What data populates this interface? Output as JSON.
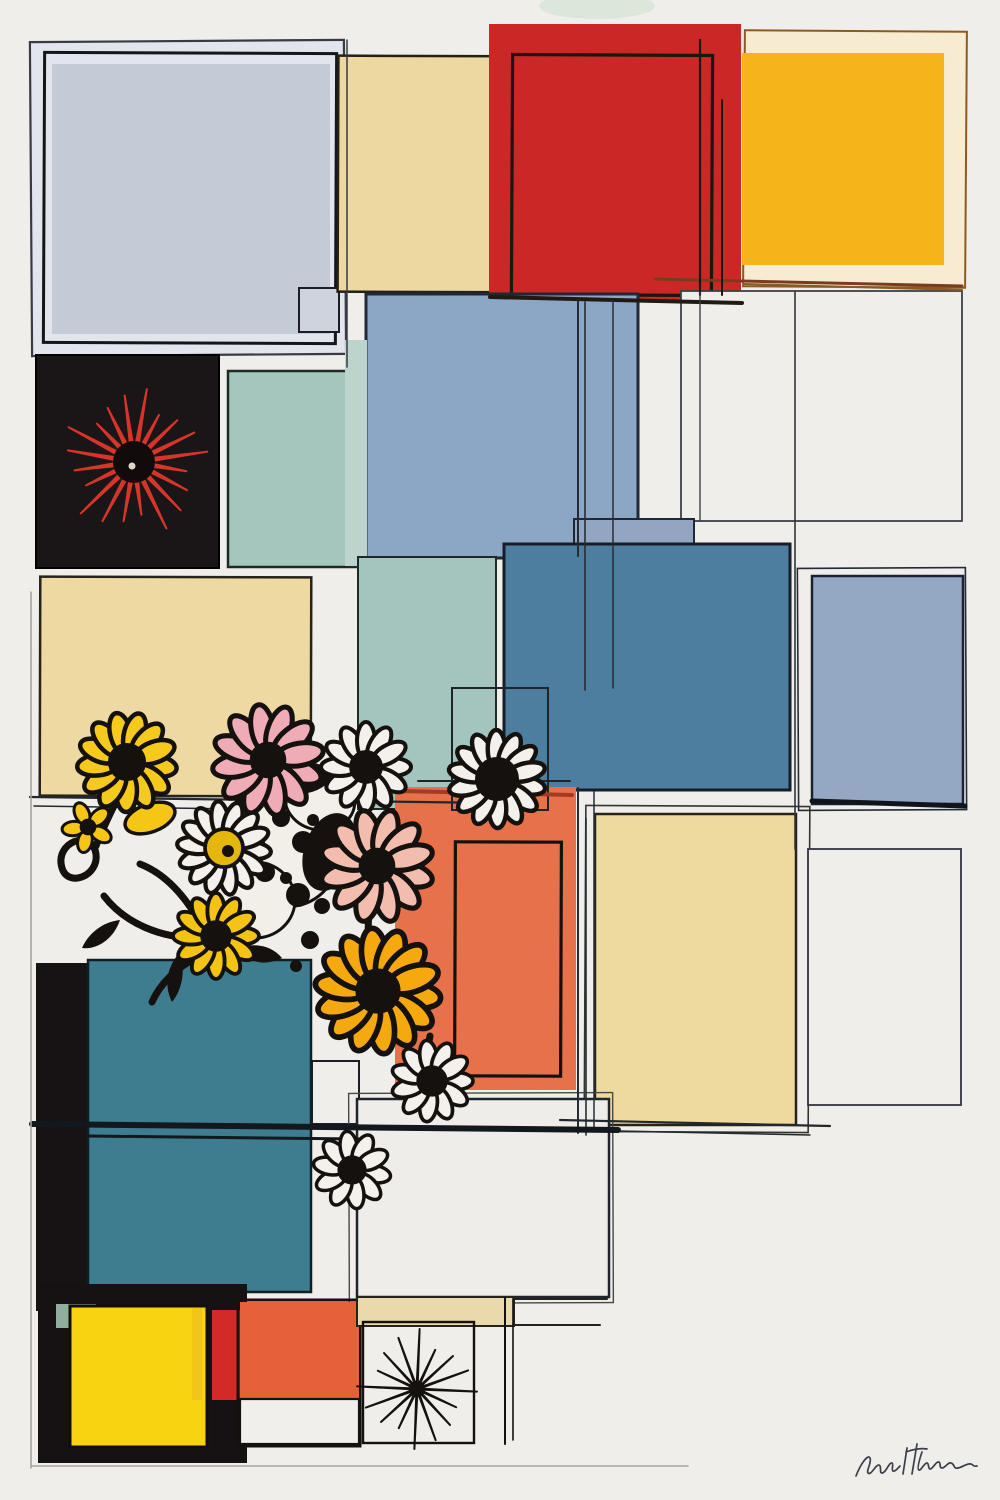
{
  "artwork": {
    "title": "Abstract grid composition with comic flowers",
    "background": "#f0eeea",
    "signature": {
      "note": "illegible cursive artist signature",
      "path": "M856 1476 c5 -13 12 -22 14 -18 c2 4 -4 13 -2 15 c3 3 8 -9 11 -8 c3 1 0 8 3 8 c4 0 7 -11 10 -10 c2 1 -1 7 1 8 c2 1 5 -3 7 -5 m7 -18 l-4 26 m14 -30 l-5 30 m-6 -22 c8 -3 15 -4 21 -3 m-5 3 c-3 9 -5 17 -3 18 c2 1 5 -7 8 -7 c2 0 1 6 3 6 c3 0 6 -8 9 -7 c2 1 0 6 3 6 c3 0 6 -6 9 -5 c4 1 2 6 7 5 c5 -1 9 -5 13 -4 c3 1 2 3 6 2",
      "color": "#3a3f4a"
    },
    "underlay": [
      {
        "name": "green-tint-top",
        "cx": 597,
        "cy": 6,
        "rx": 58,
        "ry": 13,
        "rot": 0,
        "f": "#cfe3d2",
        "o": 0.65
      }
    ],
    "rects": [
      {
        "n": "topleft-outer-frame",
        "x": 31,
        "y": 41,
        "w": 314,
        "h": 314,
        "f": "#e2e5eb",
        "s": "#383b44",
        "sw": 2.2,
        "r": -0.4
      },
      {
        "n": "topleft-sketch-outline",
        "x": 44,
        "y": 53,
        "w": 292,
        "h": 290,
        "f": "none",
        "s": "#14161c",
        "sw": 3,
        "r": 0.25
      },
      {
        "n": "topleft-bluegray-square",
        "x": 52,
        "y": 64,
        "w": 278,
        "h": 270,
        "f": "#c5cad7"
      },
      {
        "n": "topleft-corner-tab",
        "x": 299,
        "y": 288,
        "w": 40,
        "h": 44,
        "f": "#ced3de",
        "s": "#1a1d24",
        "sw": 2
      },
      {
        "n": "cream-top-square",
        "x": 338,
        "y": 56,
        "w": 192,
        "h": 236,
        "f": "#ecd8a0",
        "s": "#241f17",
        "sw": 2.5,
        "r": 0.2
      },
      {
        "n": "red-square",
        "x": 489,
        "y": 24,
        "w": 252,
        "h": 276,
        "f": "#cb2727"
      },
      {
        "n": "red-inner-sketch",
        "x": 512,
        "y": 55,
        "w": 200,
        "h": 240,
        "f": "none",
        "s": "#181711",
        "sw": 3.2,
        "r": 0.3
      },
      {
        "n": "yellow-square-frame",
        "x": 744,
        "y": 31,
        "w": 222,
        "h": 256,
        "f": "#f7ecd1",
        "s": "#8a5a22",
        "sw": 2,
        "r": 0.4
      },
      {
        "n": "yellow-square",
        "x": 742,
        "y": 53,
        "w": 202,
        "h": 212,
        "f": "#f5b51a"
      },
      {
        "n": "white-outlined-square-row2",
        "x": 681,
        "y": 291,
        "w": 281,
        "h": 230,
        "f": "#f0eeeb",
        "s": "#3c4048",
        "sw": 1.8
      },
      {
        "n": "bluegray-mid-square",
        "x": 366,
        "y": 294,
        "w": 272,
        "h": 264,
        "f": "#8ca6c6",
        "s": "#1f2835",
        "sw": 3
      },
      {
        "n": "sage-square-row2",
        "x": 228,
        "y": 371,
        "w": 137,
        "h": 196,
        "f": "#a4c6bd",
        "s": "#1c2b27",
        "sw": 2.5
      },
      {
        "n": "sage-light-strip",
        "x": 345,
        "y": 340,
        "w": 22,
        "h": 226,
        "f": "#bdd4cc"
      },
      {
        "n": "black-square",
        "x": 36,
        "y": 355,
        "w": 183,
        "h": 213,
        "f": "#1a1516",
        "s": "#000000",
        "sw": 2
      },
      {
        "n": "cream-left-square",
        "x": 40,
        "y": 577,
        "w": 271,
        "h": 219,
        "f": "#edd9a1",
        "s": "#27221a",
        "sw": 2.5,
        "r": 0.15
      },
      {
        "n": "teal-light-square",
        "x": 358,
        "y": 557,
        "w": 138,
        "h": 252,
        "f": "#a3c5bd",
        "s": "#1c2b27",
        "sw": 2
      },
      {
        "n": "bluegray-band",
        "x": 574,
        "y": 519,
        "w": 120,
        "h": 34,
        "f": "#92a5c3",
        "s": "#1f2835",
        "sw": 2
      },
      {
        "n": "steelblue-square",
        "x": 504,
        "y": 544,
        "w": 286,
        "h": 246,
        "f": "#4e7e9f",
        "s": "#141d28",
        "sw": 3
      },
      {
        "n": "bluegray-right-sketch",
        "x": 798,
        "y": 568,
        "w": 168,
        "h": 242,
        "f": "none",
        "s": "#232b38",
        "sw": 1.6,
        "r": -0.3
      },
      {
        "n": "bluegray-right-square",
        "x": 812,
        "y": 576,
        "w": 151,
        "h": 228,
        "f": "#95a8c3",
        "s": "#1b2330",
        "sw": 2.5
      },
      {
        "n": "cream-mid-sketch",
        "x": 585,
        "y": 806,
        "w": 224,
        "h": 326,
        "f": "none",
        "s": "#35352f",
        "sw": 1.6,
        "r": 0.3
      },
      {
        "n": "cream-mid-square",
        "x": 595,
        "y": 814,
        "w": 201,
        "h": 311,
        "f": "#eeda9f",
        "s": "#27221a",
        "sw": 2.5
      },
      {
        "n": "white-outlined-square-right",
        "x": 808,
        "y": 849,
        "w": 153,
        "h": 256,
        "f": "#f0eeeb",
        "s": "#31363d",
        "sw": 1.8
      },
      {
        "n": "orange-mid-square",
        "x": 395,
        "y": 787,
        "w": 181,
        "h": 303,
        "f": "#e7714b"
      },
      {
        "n": "orange-inner-sketch",
        "x": 455,
        "y": 842,
        "w": 106,
        "h": 234,
        "f": "none",
        "s": "#17110e",
        "sw": 3.2,
        "r": 0.2
      },
      {
        "n": "daisy-frame-sketch",
        "x": 452,
        "y": 688,
        "w": 96,
        "h": 122,
        "f": "none",
        "s": "#1d242b",
        "sw": 2
      },
      {
        "n": "black-strip-left",
        "x": 36,
        "y": 963,
        "w": 52,
        "h": 348,
        "f": "#171314"
      },
      {
        "n": "teal-big-square",
        "x": 88,
        "y": 960,
        "w": 223,
        "h": 332,
        "f": "#3e7d8f",
        "s": "#0f1e27",
        "sw": 2.5
      },
      {
        "n": "small-outlined-square",
        "x": 312,
        "y": 1061,
        "w": 47,
        "h": 63,
        "f": "none",
        "s": "#1a2026",
        "sw": 2
      },
      {
        "n": "white-mid-sketch",
        "x": 349,
        "y": 1093,
        "w": 264,
        "h": 210,
        "f": "none",
        "s": "#444a44",
        "sw": 1.4,
        "r": -0.2
      },
      {
        "n": "white-mid-square",
        "x": 357,
        "y": 1099,
        "w": 252,
        "h": 198,
        "f": "#efedea",
        "s": "#1f252c",
        "sw": 2.5
      },
      {
        "n": "black-bottom-square",
        "x": 38,
        "y": 1284,
        "w": 209,
        "h": 179,
        "f": "#161213"
      },
      {
        "n": "sage-chip",
        "x": 56,
        "y": 1304,
        "w": 40,
        "h": 24,
        "f": "#8fae9f"
      },
      {
        "n": "yellow-bottom-square",
        "x": 70,
        "y": 1306,
        "w": 137,
        "h": 141,
        "f": "#f7d310",
        "s": "#120e0b",
        "sw": 3
      },
      {
        "n": "yellow-sliver",
        "x": 192,
        "y": 1308,
        "w": 10,
        "h": 92,
        "f": "#f2c616"
      },
      {
        "n": "red-sliver",
        "x": 212,
        "y": 1310,
        "w": 28,
        "h": 90,
        "f": "#d12a28"
      },
      {
        "n": "orange-bottom-outline",
        "x": 238,
        "y": 1300,
        "w": 122,
        "h": 146,
        "f": "none",
        "s": "#15110e",
        "sw": 3
      },
      {
        "n": "orange-bottom-square",
        "x": 240,
        "y": 1302,
        "w": 119,
        "h": 97,
        "f": "#e6603a"
      },
      {
        "n": "white-bottom-square",
        "x": 240,
        "y": 1399,
        "w": 119,
        "h": 45,
        "f": "#f1efec",
        "s": "#15110e",
        "sw": 2.2
      },
      {
        "n": "beige-strip",
        "x": 357,
        "y": 1297,
        "w": 157,
        "h": 29,
        "f": "#ead9ab",
        "s": "#27221a",
        "sw": 2
      },
      {
        "n": "dandelion-square",
        "x": 363,
        "y": 1322,
        "w": 111,
        "h": 121,
        "f": "none",
        "s": "#15110e",
        "sw": 2.4
      }
    ],
    "lines": [
      {
        "x1": 490,
        "y1": 297,
        "x2": 742,
        "y2": 303,
        "s": "#201a12",
        "w": 4
      },
      {
        "x1": 655,
        "y1": 279,
        "x2": 962,
        "y2": 286,
        "s": "#7a3c1e",
        "w": 3
      },
      {
        "x1": 700,
        "y1": 40,
        "x2": 700,
        "y2": 295,
        "s": "#181711",
        "w": 2.2
      },
      {
        "x1": 722,
        "y1": 100,
        "x2": 722,
        "y2": 295,
        "s": "#181711",
        "w": 2
      },
      {
        "x1": 744,
        "y1": 284,
        "x2": 962,
        "y2": 290,
        "s": "#8a5a22",
        "w": 2
      },
      {
        "x1": 578,
        "y1": 300,
        "x2": 578,
        "y2": 556,
        "s": "#262c36",
        "w": 2
      },
      {
        "x1": 585,
        "y1": 302,
        "x2": 585,
        "y2": 690,
        "s": "#262c36",
        "w": 1.6
      },
      {
        "x1": 613,
        "y1": 300,
        "x2": 613,
        "y2": 688,
        "s": "#262c36",
        "w": 1.5
      },
      {
        "x1": 795,
        "y1": 292,
        "x2": 795,
        "y2": 849,
        "s": "#30353c",
        "w": 1.6
      },
      {
        "x1": 700,
        "y1": 292,
        "x2": 700,
        "y2": 520,
        "s": "#3c4048",
        "w": 1.4
      },
      {
        "x1": 30,
        "y1": 797,
        "x2": 497,
        "y2": 803,
        "s": "#23282e",
        "w": 2.2
      },
      {
        "x1": 34,
        "y1": 806,
        "x2": 310,
        "y2": 810,
        "s": "#23282e",
        "w": 1.5
      },
      {
        "x1": 418,
        "y1": 781,
        "x2": 570,
        "y2": 781,
        "s": "#1d242b",
        "w": 2
      },
      {
        "x1": 400,
        "y1": 791,
        "x2": 572,
        "y2": 795,
        "s": "#a33c20",
        "w": 4
      },
      {
        "x1": 578,
        "y1": 788,
        "x2": 578,
        "y2": 1133,
        "s": "#262c36",
        "w": 2
      },
      {
        "x1": 586,
        "y1": 818,
        "x2": 586,
        "y2": 1135,
        "s": "#262c36",
        "w": 1.6
      },
      {
        "x1": 594,
        "y1": 792,
        "x2": 594,
        "y2": 1130,
        "s": "#262c36",
        "w": 1.5
      },
      {
        "x1": 560,
        "y1": 1120,
        "x2": 830,
        "y2": 1126,
        "s": "#23282e",
        "w": 2.2
      },
      {
        "x1": 568,
        "y1": 1130,
        "x2": 810,
        "y2": 1135,
        "s": "#23282e",
        "w": 1.5
      },
      {
        "x1": 812,
        "y1": 801,
        "x2": 965,
        "y2": 806,
        "s": "#10141c",
        "w": 5
      },
      {
        "x1": 32,
        "y1": 1124,
        "x2": 618,
        "y2": 1130,
        "s": "#12181e",
        "w": 6
      },
      {
        "x1": 88,
        "y1": 1136,
        "x2": 360,
        "y2": 1139,
        "s": "#12181e",
        "w": 3
      },
      {
        "x1": 513,
        "y1": 1299,
        "x2": 607,
        "y2": 1299,
        "s": "#27221a",
        "w": 2
      },
      {
        "x1": 513,
        "y1": 1325,
        "x2": 600,
        "y2": 1325,
        "s": "#27221a",
        "w": 2
      },
      {
        "x1": 505,
        "y1": 1298,
        "x2": 505,
        "y2": 1444,
        "s": "#15110e",
        "w": 2
      },
      {
        "x1": 513,
        "y1": 1300,
        "x2": 513,
        "y2": 1440,
        "s": "#15110e",
        "w": 1.6
      },
      {
        "x1": 31,
        "y1": 592,
        "x2": 31,
        "y2": 1468,
        "s": "#a7a49d",
        "w": 1.6
      },
      {
        "x1": 31,
        "y1": 1466,
        "x2": 688,
        "y2": 1466,
        "s": "#a7a49d",
        "w": 1.6
      },
      {
        "x1": 347,
        "y1": 40,
        "x2": 347,
        "y2": 367,
        "s": "#383b44",
        "w": 1.5
      }
    ],
    "blobs": [
      {
        "n": "cow-blob-main",
        "cx": 285,
        "cy": 845,
        "rx": 55,
        "ry": 62,
        "rot": -15,
        "f": "#f2efe9",
        "s": "#15110e",
        "sw": 3
      },
      {
        "n": "cow-blob-low",
        "cx": 255,
        "cy": 900,
        "rx": 40,
        "ry": 38,
        "rot": 0,
        "f": "#f2efe9",
        "s": "#15110e",
        "sw": 3
      },
      {
        "n": "cow-blob-top",
        "cx": 320,
        "cy": 800,
        "rx": 35,
        "ry": 30,
        "rot": 10,
        "f": "#f2efe9",
        "s": "#15110e",
        "sw": 3
      },
      {
        "n": "black-blob",
        "cx": 330,
        "cy": 852,
        "rx": 26,
        "ry": 40,
        "rot": 18,
        "f": "#15110e",
        "s": "none",
        "sw": 0
      },
      {
        "n": "black-blob-2",
        "cx": 300,
        "cy": 778,
        "rx": 30,
        "ry": 16,
        "rot": -5,
        "f": "#15110e",
        "s": "none",
        "sw": 0
      },
      {
        "n": "yellow-crescent",
        "cx": 150,
        "cy": 818,
        "rx": 26,
        "ry": 14,
        "rot": -20,
        "f": "#f5c616",
        "s": "#15110e",
        "sw": 3.5
      }
    ],
    "spots": [
      [
        253,
        803,
        7
      ],
      [
        281,
        818,
        9
      ],
      [
        303,
        842,
        11
      ],
      [
        265,
        872,
        10
      ],
      [
        298,
        895,
        12
      ],
      [
        322,
        906,
        8
      ],
      [
        250,
        917,
        6
      ],
      [
        334,
        870,
        8
      ],
      [
        259,
        843,
        6
      ],
      [
        286,
        878,
        6
      ],
      [
        313,
        820,
        6
      ],
      [
        243,
        862,
        5
      ],
      [
        310,
        940,
        9
      ],
      [
        330,
        962,
        7
      ],
      [
        296,
        966,
        6
      ],
      [
        466,
        790,
        6
      ],
      [
        492,
        793,
        5
      ]
    ],
    "stems": [
      "M62 868 c-8 -26 30 -40 34 -14 c3 22 -28 34 -34 14 z",
      "M96 846 c10 -26 22 -48 30 -64",
      "M104 896 c20 26 56 44 102 42",
      "M140 864 c26 10 48 34 66 70",
      "M236 788 c6 18 0 40 -10 56",
      "M372 896 c-8 30 -2 62 6 92",
      "M430 1036 c-4 18 -2 32 2 44",
      "M196 958 c-20 10 -36 26 -44 44"
    ],
    "leaves": [
      "M238 948 c18 -6 34 -2 44 10 c-16 8 -34 6 -44 -10 z",
      "M180 952 c-14 16 -16 34 -8 50 c10 -12 14 -32 8 -50 z",
      "M120 920 c-18 2 -32 14 -38 28 c16 2 32 -10 38 -28 z"
    ],
    "flowers": [
      {
        "n": "red-starburst-flower",
        "kind": "spiky",
        "cx": 134,
        "cy": 462,
        "r": 74,
        "count": 20,
        "petal": "#d5352a",
        "core": "#120b0b",
        "coreR": 21,
        "rot": 10,
        "wf": 0.6,
        "dot": "#ddd8cc"
      },
      {
        "n": "yellow-sunflower",
        "kind": "daisy",
        "cx": 127,
        "cy": 762,
        "r": 50,
        "count": 13,
        "petal": "#f6c91d",
        "core": "#15110e",
        "coreR": 17,
        "rot": 8,
        "pw": 0.42
      },
      {
        "n": "yellow-bud",
        "kind": "daisy",
        "cx": 88,
        "cy": 827,
        "r": 26,
        "count": 5,
        "petal": "#f5c616",
        "core": "#15110e",
        "coreR": 7,
        "rot": 30,
        "pw": 0.55
      },
      {
        "n": "pink-daisy-upper",
        "kind": "daisy",
        "cx": 268,
        "cy": 760,
        "r": 56,
        "count": 12,
        "petal": "#efacb6",
        "core": "#15110e",
        "coreR": 16,
        "rot": 20,
        "pw": 0.4
      },
      {
        "n": "white-daisy-upper",
        "kind": "daisy",
        "cx": 366,
        "cy": 767,
        "r": 45,
        "count": 12,
        "petal": "#f4f1ec",
        "core": "#15110e",
        "coreR": 15,
        "rot": 0,
        "pw": 0.4
      },
      {
        "n": "white-daisy-right",
        "kind": "daisy",
        "cx": 497,
        "cy": 779,
        "r": 49,
        "count": 14,
        "petal": "#f4f1ec",
        "core": "#15110e",
        "coreR": 20,
        "rot": 12,
        "pw": 0.36
      },
      {
        "n": "white-daisy-yellow-core",
        "kind": "daisy",
        "cx": 224,
        "cy": 848,
        "r": 47,
        "count": 14,
        "petal": "#f4f1ec",
        "core": "#e5b60e",
        "coreR": 19,
        "rot": 5,
        "pw": 0.36,
        "swirl": true
      },
      {
        "n": "pink-daisy-lower",
        "kind": "daisy",
        "cx": 377,
        "cy": 866,
        "r": 57,
        "count": 12,
        "petal": "#f2bcae",
        "core": "#15110e",
        "coreR": 16,
        "rot": 15,
        "pw": 0.4
      },
      {
        "n": "yellow-daisy-small",
        "kind": "daisy",
        "cx": 216,
        "cy": 936,
        "r": 43,
        "count": 12,
        "petal": "#f4c414",
        "core": "#15110e",
        "coreR": 14,
        "rot": 0,
        "pw": 0.4
      },
      {
        "n": "yellow-daisy-big",
        "kind": "daisy",
        "cx": 378,
        "cy": 991,
        "r": 63,
        "count": 14,
        "petal": "#f6a90e",
        "core": "#15110e",
        "coreR": 20,
        "rot": 7,
        "pw": 0.4
      },
      {
        "n": "white-daisy-mid",
        "kind": "daisy",
        "cx": 432,
        "cy": 1081,
        "r": 41,
        "count": 11,
        "petal": "#f4f1ec",
        "core": "#15110e",
        "coreR": 14,
        "rot": 0,
        "pw": 0.42
      },
      {
        "n": "white-daisy-low",
        "kind": "daisy",
        "cx": 352,
        "cy": 1170,
        "r": 39,
        "count": 10,
        "petal": "#f4f1ec",
        "core": "#15110e",
        "coreR": 13,
        "rot": 10,
        "pw": 0.44
      },
      {
        "n": "black-dandelion",
        "kind": "spiky",
        "cx": 417,
        "cy": 1389,
        "r": 60,
        "count": 16,
        "petal": "#15110e",
        "core": "#15110e",
        "coreR": 8,
        "rot": 25,
        "wf": 0.4
      }
    ]
  }
}
